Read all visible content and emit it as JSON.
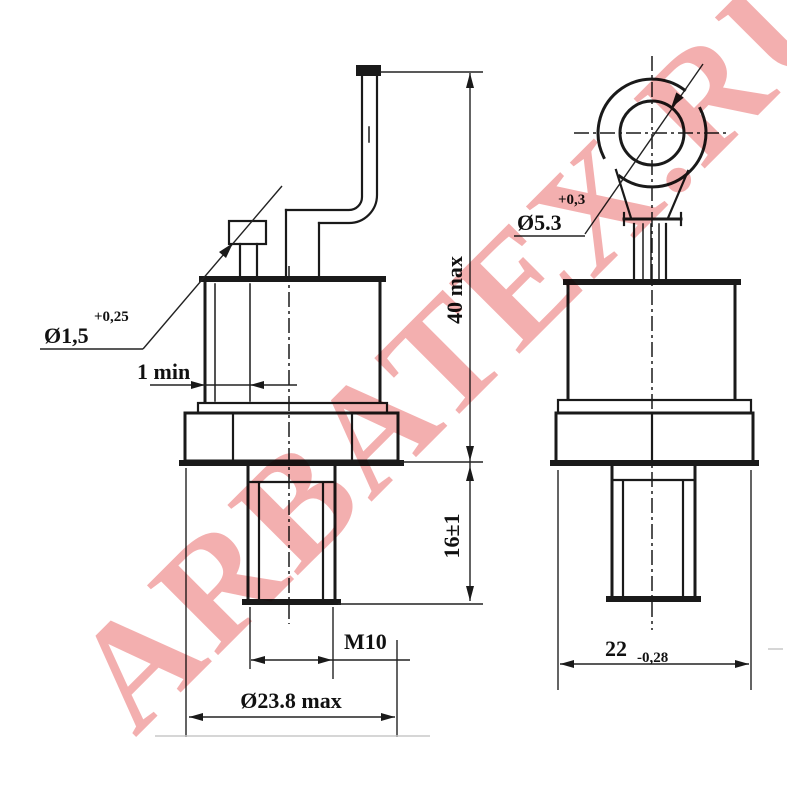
{
  "watermark": {
    "text": "ARBATEX.RU",
    "color": "#e55656"
  },
  "views": {
    "side_view": {
      "gate_lead_dia": {
        "base": "Ø1,5",
        "tol": "+0,25"
      },
      "edge_min": "1 min",
      "overall_height": "40 max",
      "stud_length": "16±1",
      "thread": "M10",
      "body_dia": "Ø23.8 max"
    },
    "front_view": {
      "hole_dia": {
        "base": "Ø5.3",
        "tol": "+0,3"
      },
      "hex_width": {
        "base": "22",
        "tol": "-0,28"
      }
    }
  },
  "colors": {
    "line": "#1a1a1a",
    "background": "#ffffff"
  }
}
